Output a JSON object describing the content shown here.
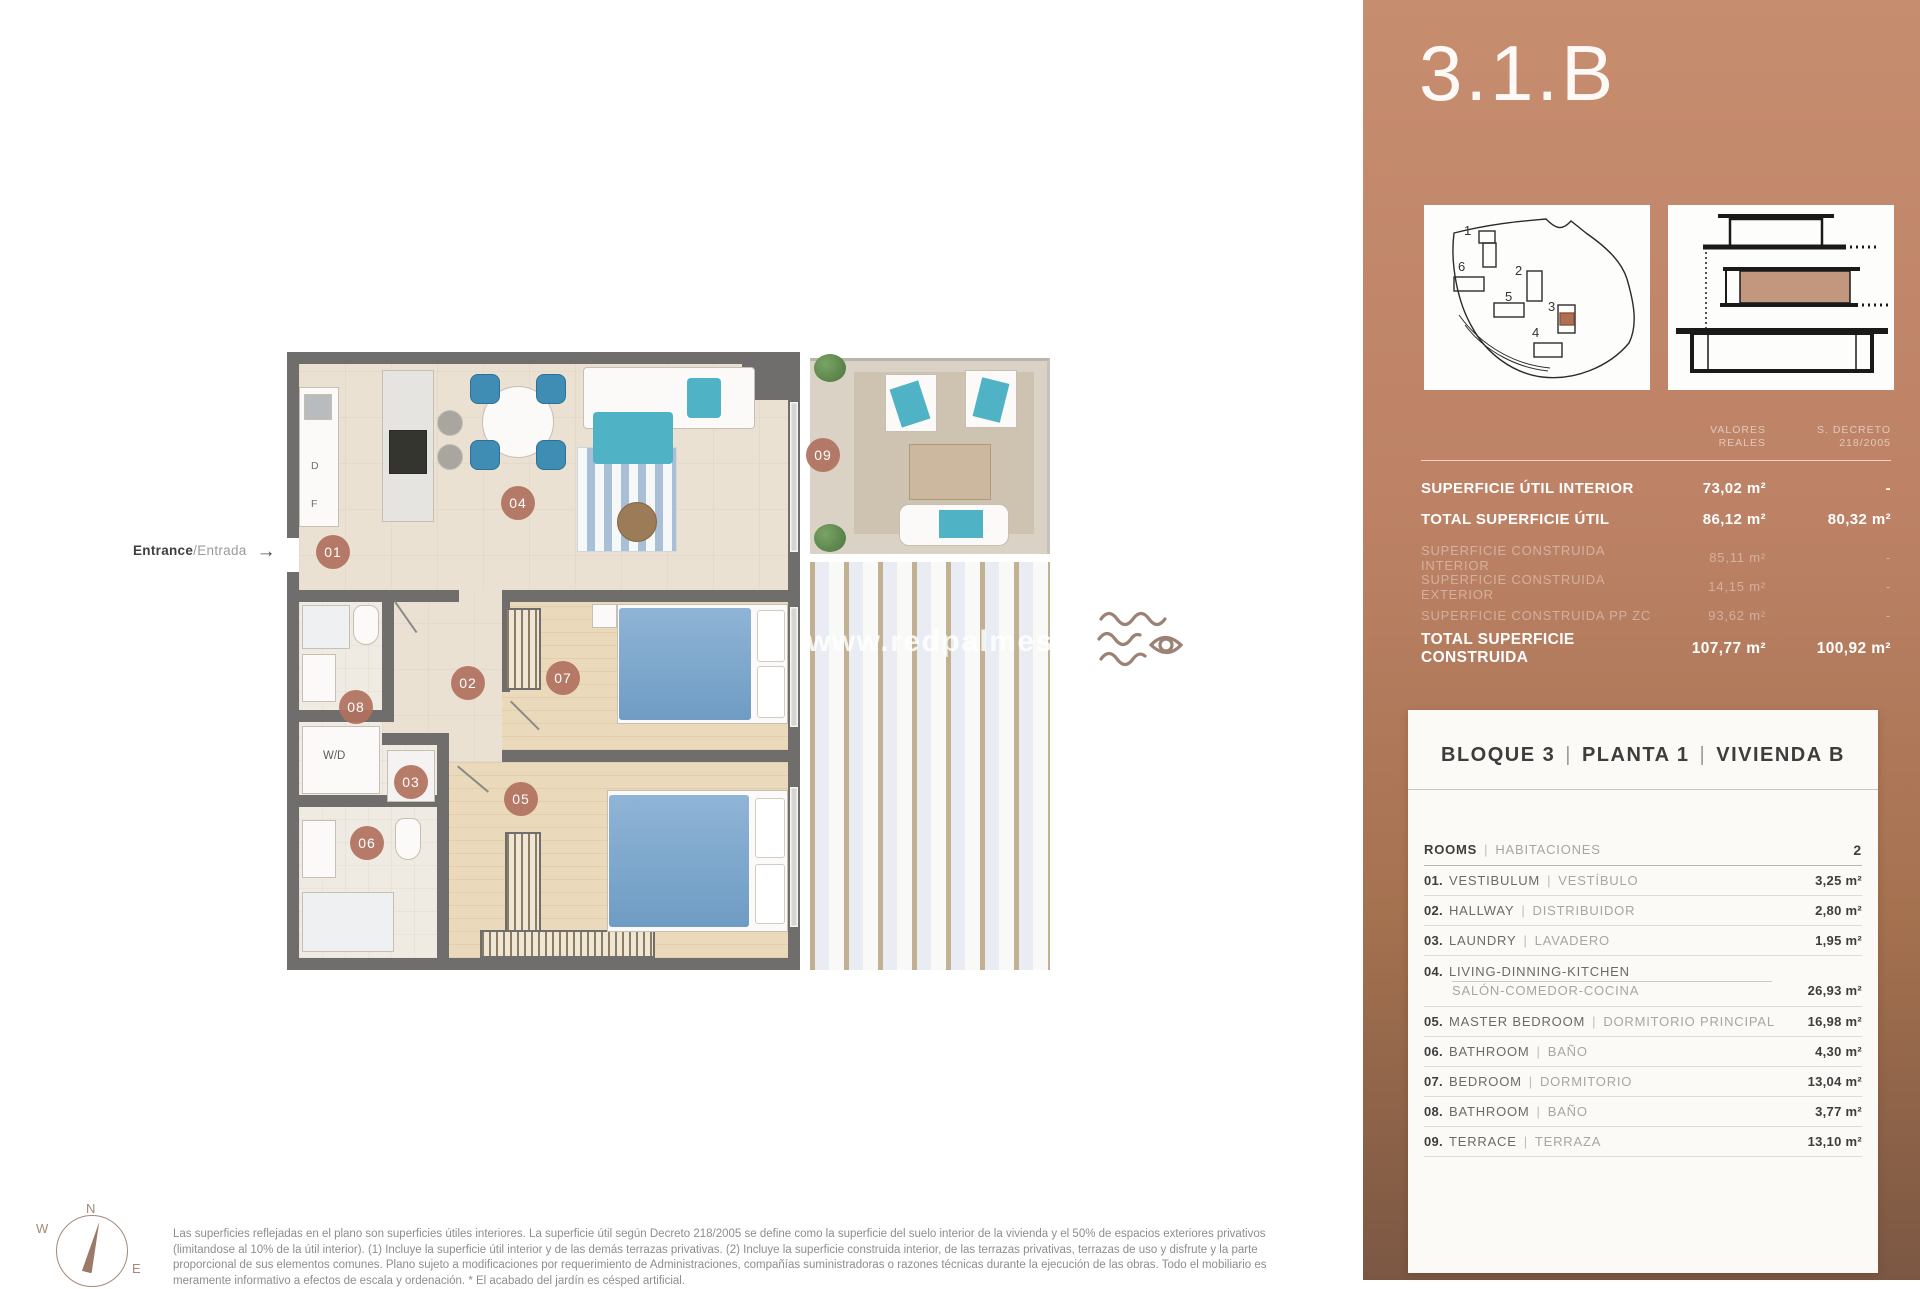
{
  "title": "3.1.B",
  "entrance": {
    "en": "Entrance",
    "es": "/Entrada",
    "arrow": "→"
  },
  "watermark": "www.redpalmestate",
  "plan": {
    "room_bubbles": [
      {
        "num": "01"
      },
      {
        "num": "02"
      },
      {
        "num": "03"
      },
      {
        "num": "04"
      },
      {
        "num": "05"
      },
      {
        "num": "06"
      },
      {
        "num": "07"
      },
      {
        "num": "08"
      },
      {
        "num": "09"
      }
    ],
    "labels": {
      "washer_dryer": "W/D",
      "dishwasher": "D",
      "fridge": "F"
    }
  },
  "compass": {
    "north": "N",
    "west": "W",
    "east": "E"
  },
  "site_plan": {
    "buildings": [
      "1",
      "2",
      "3",
      "4",
      "5",
      "6"
    ],
    "highlighted": "3"
  },
  "areas_table": {
    "col1": [
      "VALORES",
      "REALES"
    ],
    "col2": [
      "S. DECRETO",
      "218/2005"
    ],
    "rows": [
      {
        "label": "SUPERFICIE ÚTIL INTERIOR",
        "real": "73,02 m²",
        "decreto": "-"
      },
      {
        "label": "TOTAL SUPERFICIE ÚTIL",
        "real": "86,12 m²",
        "decreto": "80,32 m²"
      },
      {
        "label": "SUPERFICIE CONSTRUIDA INTERIOR",
        "real": "85,11 m²",
        "decreto": "-"
      },
      {
        "label": "SUPERFICIE CONSTRUIDA EXTERIOR",
        "real": "14,15 m²",
        "decreto": "-"
      },
      {
        "label": "SUPERFICIE CONSTRUIDA PP ZC",
        "real": "93,62 m²",
        "decreto": "-"
      },
      {
        "label": "TOTAL SUPERFICIE CONSTRUIDA",
        "real": "107,77 m²",
        "decreto": "100,92 m²"
      }
    ]
  },
  "unit_card": {
    "block": "BLOQUE 3",
    "floor": "PLANTA 1",
    "unit": "VIVIENDA B",
    "pipe": "|",
    "rooms_header": {
      "en": "ROOMS",
      "es": "HABITACIONES",
      "count": "2"
    },
    "rows": [
      {
        "num": "01.",
        "en": "VESTIBULUM",
        "es": "VESTÍBULO",
        "area": "3,25 m²"
      },
      {
        "num": "02.",
        "en": "HALLWAY",
        "es": "DISTRIBUIDOR",
        "area": "2,80 m²"
      },
      {
        "num": "03.",
        "en": "LAUNDRY",
        "es": "LAVADERO",
        "area": "1,95 m²"
      },
      {
        "num": "04.",
        "en": "LIVING-DINNING-KITCHEN",
        "es": "SALÓN-COMEDOR-COCINA",
        "area": "26,93 m²"
      },
      {
        "num": "05.",
        "en": "MASTER BEDROOM",
        "es": "DORMITORIO PRINCIPAL",
        "area": "16,98 m²"
      },
      {
        "num": "06.",
        "en": "BATHROOM",
        "es": "BAÑO",
        "area": "4,30 m²"
      },
      {
        "num": "07.",
        "en": "BEDROOM",
        "es": "DORMITORIO",
        "area": "13,04 m²"
      },
      {
        "num": "08.",
        "en": "BATHROOM",
        "es": "BAÑO",
        "area": "3,77 m²"
      },
      {
        "num": "09.",
        "en": "TERRACE",
        "es": "TERRAZA",
        "area": "13,10 m²"
      }
    ]
  },
  "disclaimer": [
    "Las superficies reflejadas en el plano son superficies útiles interiores. La superficie útil según Decreto 218/2005 se define como la superficie del suelo interior de la vivienda y el 50% de espacios exteriores privativos",
    "(limitandose al 10% de la útil interior). (1) Incluye la superficie útil interior y de las demás terrazas privativas. (2) Incluye la superficie construida interior, de las terrazas privativas, terrazas de uso y disfrute y la parte",
    "proporcional de sus elementos comunes. Plano sujeto a modificaciones por requerimiento de Administraciones, compañías suministradoras o razones técnicas durante la ejecución de las obras. Todo el mobiliario es",
    "meramente informativo a efectos de escala y ordenación. * El acabado del jardín es césped artificial."
  ]
}
